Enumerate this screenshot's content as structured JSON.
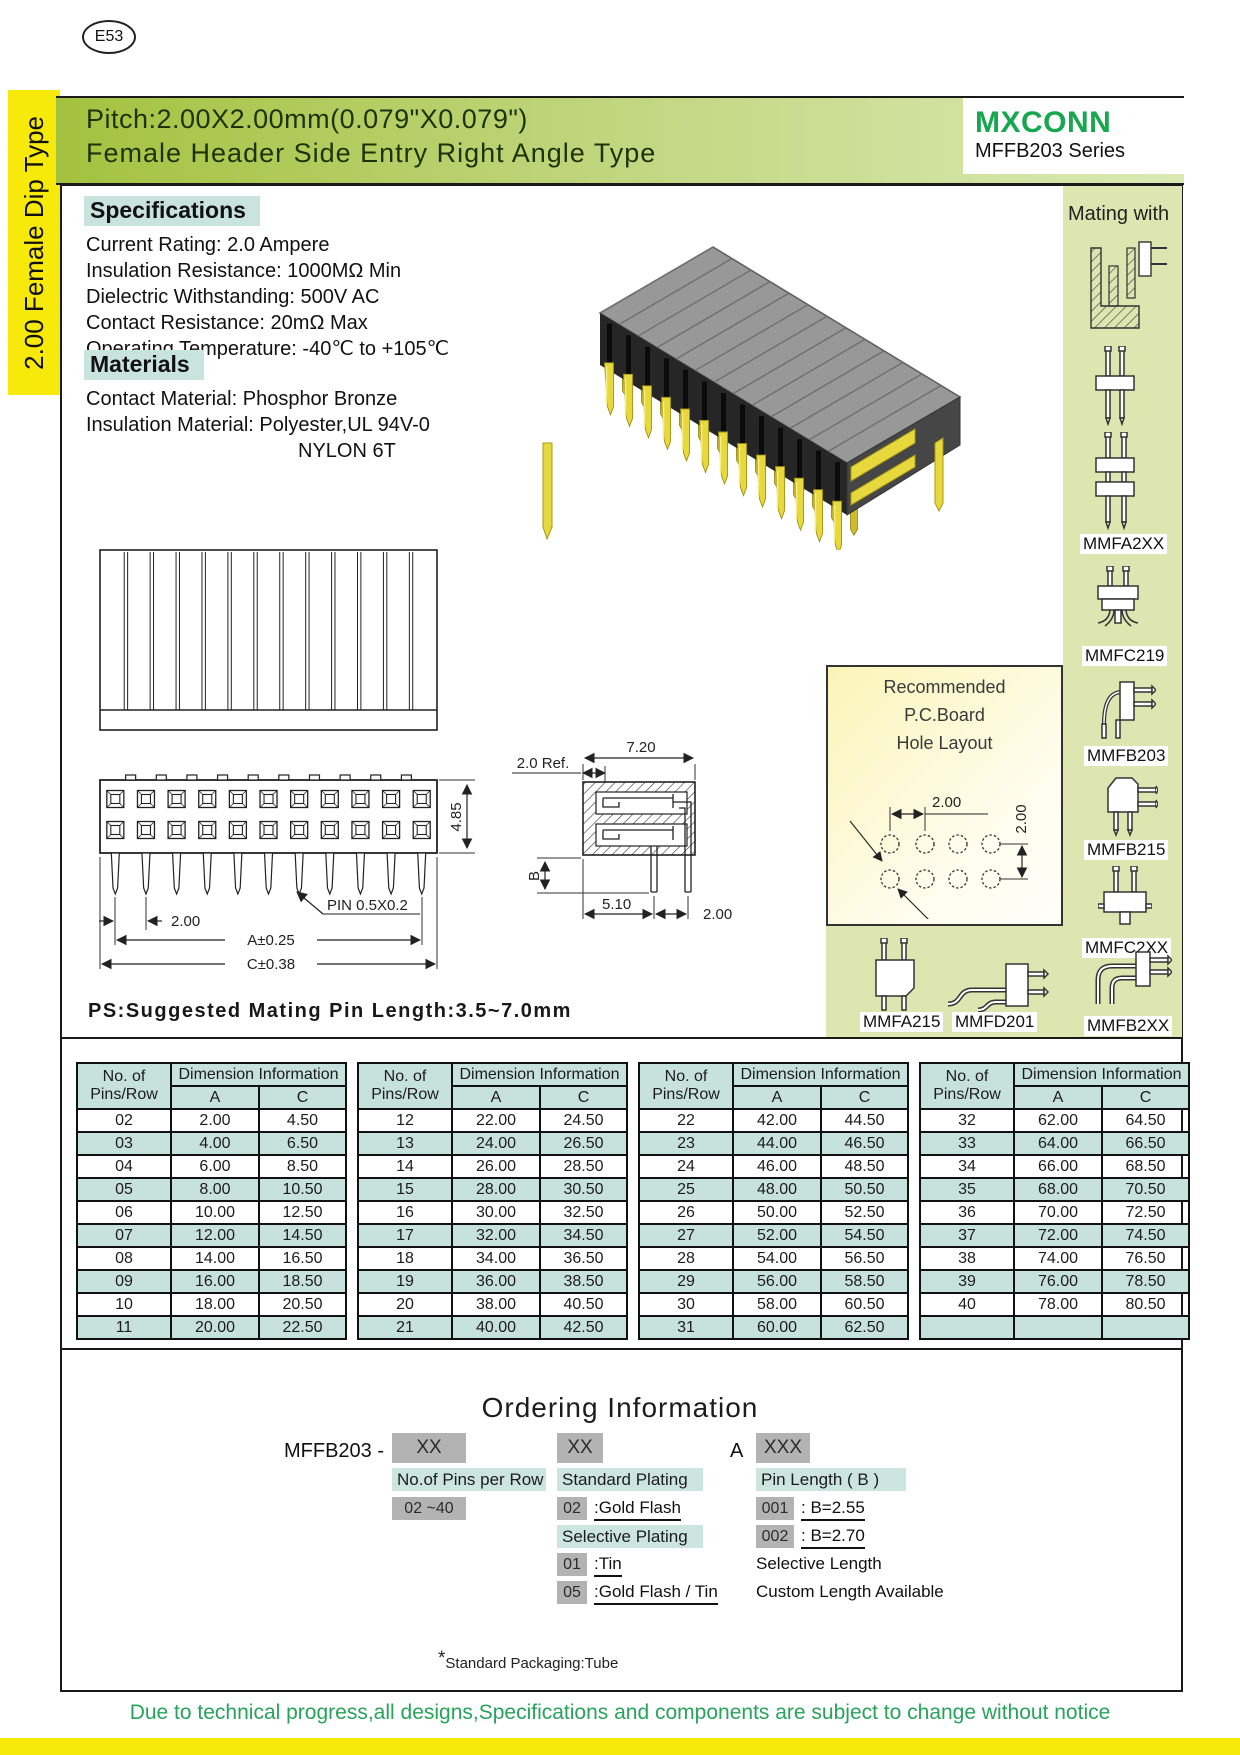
{
  "page": {
    "code": "E53",
    "side_tab": "2.00 Female Dip Type",
    "packaging_star": "*",
    "packaging_note": "Standard Packaging:Tube",
    "footer_note": "Due to technical progress,all designs,Specifications and components are subject to change without notice"
  },
  "header": {
    "title_line1": "Pitch:2.00X2.00mm(0.079\"X0.079\")",
    "title_line2": "Female Header Side Entry Right Angle Type",
    "brand": "MXCONN",
    "series": "MFFB203 Series",
    "brand_color": "#17a74f",
    "band_color_left": "#a3c23f",
    "band_color_right": "#dbeab4"
  },
  "specifications": {
    "heading": "Specifications",
    "items": [
      "Current Rating: 2.0 Ampere",
      "Insulation Resistance: 1000MΩ Min",
      "Dielectric Withstanding: 500V AC",
      "Contact  Resistance: 20mΩ Max",
      "Operating Temperature: -40℃ to +105℃"
    ]
  },
  "materials": {
    "heading": "Materials",
    "items": [
      "Contact Material: Phosphor Bronze",
      "Insulation Material: Polyester,UL 94V-0",
      "NYLON 6T"
    ]
  },
  "mating": {
    "heading": "Mating with",
    "labels": [
      "MMFA2XX",
      "MMFC219",
      "MMFB203",
      "MMFB215",
      "MMFC2XX",
      "MMFA215",
      "MMFD201",
      "MMFB2XX"
    ]
  },
  "pcb_box": {
    "title_line1": "Recommended",
    "title_line2": "P.C.Board",
    "title_line3": "Hole  Layout",
    "dim_horizontal": "2.00",
    "dim_vertical": "2.00",
    "hole_diameter": "ø0.85"
  },
  "drawing": {
    "ps_note": "PS:Suggested Mating Pin Length:3.5~7.0mm",
    "dim_pitch_front": "2.00",
    "pin_label": "PIN  0.5X0.2",
    "dim_a": "A±0.25",
    "dim_c": "C±0.38",
    "dim_width_top": "7.20",
    "dim_ref": "2.0  Ref.",
    "dim_height": "4.85",
    "dim_b": "B",
    "dim_bottom1": "5.10",
    "dim_bottom2": "2.00"
  },
  "tables": {
    "header": {
      "col1a": "No. of",
      "col1b": "Pins/Row",
      "dim": "Dimension Information",
      "a": "A",
      "c": "C"
    },
    "groups": [
      {
        "rows": [
          [
            "02",
            "2.00",
            "4.50"
          ],
          [
            "03",
            "4.00",
            "6.50"
          ],
          [
            "04",
            "6.00",
            "8.50"
          ],
          [
            "05",
            "8.00",
            "10.50"
          ],
          [
            "06",
            "10.00",
            "12.50"
          ],
          [
            "07",
            "12.00",
            "14.50"
          ],
          [
            "08",
            "14.00",
            "16.50"
          ],
          [
            "09",
            "16.00",
            "18.50"
          ],
          [
            "10",
            "18.00",
            "20.50"
          ],
          [
            "11",
            "20.00",
            "22.50"
          ]
        ]
      },
      {
        "rows": [
          [
            "12",
            "22.00",
            "24.50"
          ],
          [
            "13",
            "24.00",
            "26.50"
          ],
          [
            "14",
            "26.00",
            "28.50"
          ],
          [
            "15",
            "28.00",
            "30.50"
          ],
          [
            "16",
            "30.00",
            "32.50"
          ],
          [
            "17",
            "32.00",
            "34.50"
          ],
          [
            "18",
            "34.00",
            "36.50"
          ],
          [
            "19",
            "36.00",
            "38.50"
          ],
          [
            "20",
            "38.00",
            "40.50"
          ],
          [
            "21",
            "40.00",
            "42.50"
          ]
        ]
      },
      {
        "rows": [
          [
            "22",
            "42.00",
            "44.50"
          ],
          [
            "23",
            "44.00",
            "46.50"
          ],
          [
            "24",
            "46.00",
            "48.50"
          ],
          [
            "25",
            "48.00",
            "50.50"
          ],
          [
            "26",
            "50.00",
            "52.50"
          ],
          [
            "27",
            "52.00",
            "54.50"
          ],
          [
            "28",
            "54.00",
            "56.50"
          ],
          [
            "29",
            "56.00",
            "58.50"
          ],
          [
            "30",
            "58.00",
            "60.50"
          ],
          [
            "31",
            "60.00",
            "62.50"
          ]
        ]
      },
      {
        "rows": [
          [
            "32",
            "62.00",
            "64.50"
          ],
          [
            "33",
            "64.00",
            "66.50"
          ],
          [
            "34",
            "66.00",
            "68.50"
          ],
          [
            "35",
            "68.00",
            "70.50"
          ],
          [
            "36",
            "70.00",
            "72.50"
          ],
          [
            "37",
            "72.00",
            "74.50"
          ],
          [
            "38",
            "74.00",
            "76.50"
          ],
          [
            "39",
            "76.00",
            "78.50"
          ],
          [
            "40",
            "78.00",
            "80.50"
          ],
          [
            "",
            "",
            ""
          ]
        ]
      }
    ]
  },
  "ordering": {
    "title": "Ordering Information",
    "part_prefix": "MFFB203 -",
    "code1": "XX",
    "code2": "XX",
    "sep": "A",
    "code3": "XXX",
    "pins_head": "No.of Pins per Row",
    "pins_range": "02 ~40",
    "plating_head1": "Standard Plating",
    "plating1_code": "02",
    "plating1_label": ":Gold Flash",
    "plating_head2": "Selective Plating",
    "plating2_code": "01",
    "plating2_label": ":Tin",
    "plating3_code": "05",
    "plating3_label": ":Gold Flash / Tin",
    "length_head": "Pin Length ( B )",
    "length1_code": "001",
    "length1_label": ": B=2.55",
    "length2_code": "002",
    "length2_label": ": B=2.70",
    "length_note1": "Selective Length",
    "length_note2": "Custom Length Available"
  }
}
